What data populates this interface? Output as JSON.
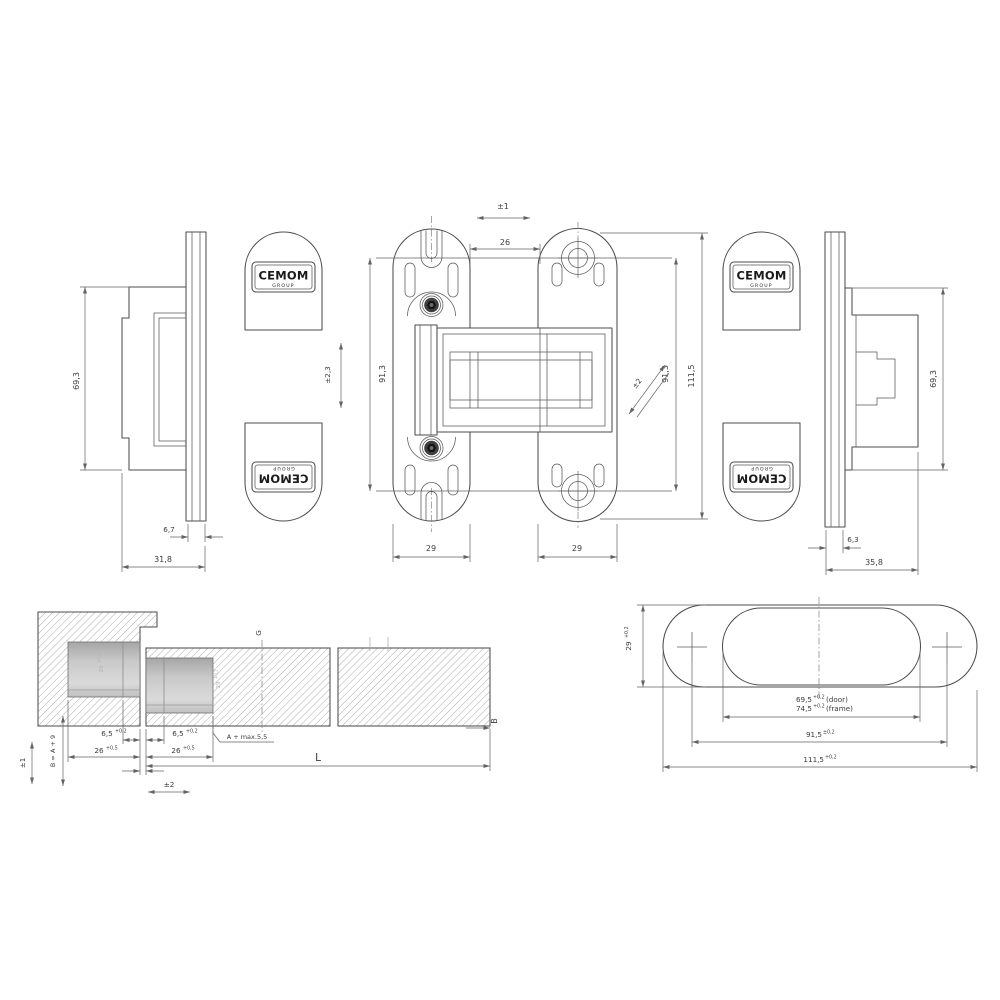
{
  "brand": {
    "name": "CEMOM",
    "sub": "GROUP"
  },
  "dims": {
    "side_left": {
      "height": "69,3",
      "plate": "6,7",
      "depth": "31,8"
    },
    "front": {
      "adjust_horizontal": "±1",
      "gap": "26",
      "adjust_vertical": "±2,3",
      "screw_span_left": "91,3",
      "screw_span_right": "91,3",
      "adjust_diagonal": "±2",
      "total_height": "111,5",
      "plate_width_left": "29",
      "plate_width_right": "29"
    },
    "side_right": {
      "height": "69,3",
      "plate": "6,3",
      "depth": "35,8"
    },
    "section": {
      "adjust_vertical": "±1",
      "depth_formula": "B = A + 9",
      "frame_lip": "6,5",
      "frame_lip_tol": "+0,2",
      "frame_pocket": "26",
      "frame_pocket_tol": "+0,5",
      "frame_pocket_width": "29",
      "frame_pocket_width_tol": "+0,2",
      "door_lip": "6,5",
      "door_lip_tol": "+0,2",
      "door_pocket": "26",
      "door_pocket_tol": "+0,5",
      "door_pocket_width": "29",
      "door_pocket_width_tol": "+0,2",
      "pocket_depth_note": "A + max.5,5",
      "adjust_horizontal": "±2",
      "axis_label": "G",
      "door_length": "L",
      "door_edge": "B"
    },
    "template": {
      "slot_width": "29",
      "slot_width_tol": "+0,2",
      "inner_door": "69,5",
      "inner_door_tol": "+0,2",
      "inner_door_note": "(door)",
      "inner_frame": "74,5",
      "inner_frame_tol": "+0,2",
      "inner_frame_note": "(frame)",
      "hole_centers": "91,5",
      "hole_centers_tol": "±0,2",
      "outer_length": "111,5",
      "outer_length_tol": "+0,2"
    }
  },
  "colors": {
    "line": "#4d4d4d",
    "dimension": "#636363",
    "hatch": "#979797",
    "pocket_dark": "#a6a6a6",
    "pocket_light": "#dadada",
    "background": "#ffffff"
  }
}
